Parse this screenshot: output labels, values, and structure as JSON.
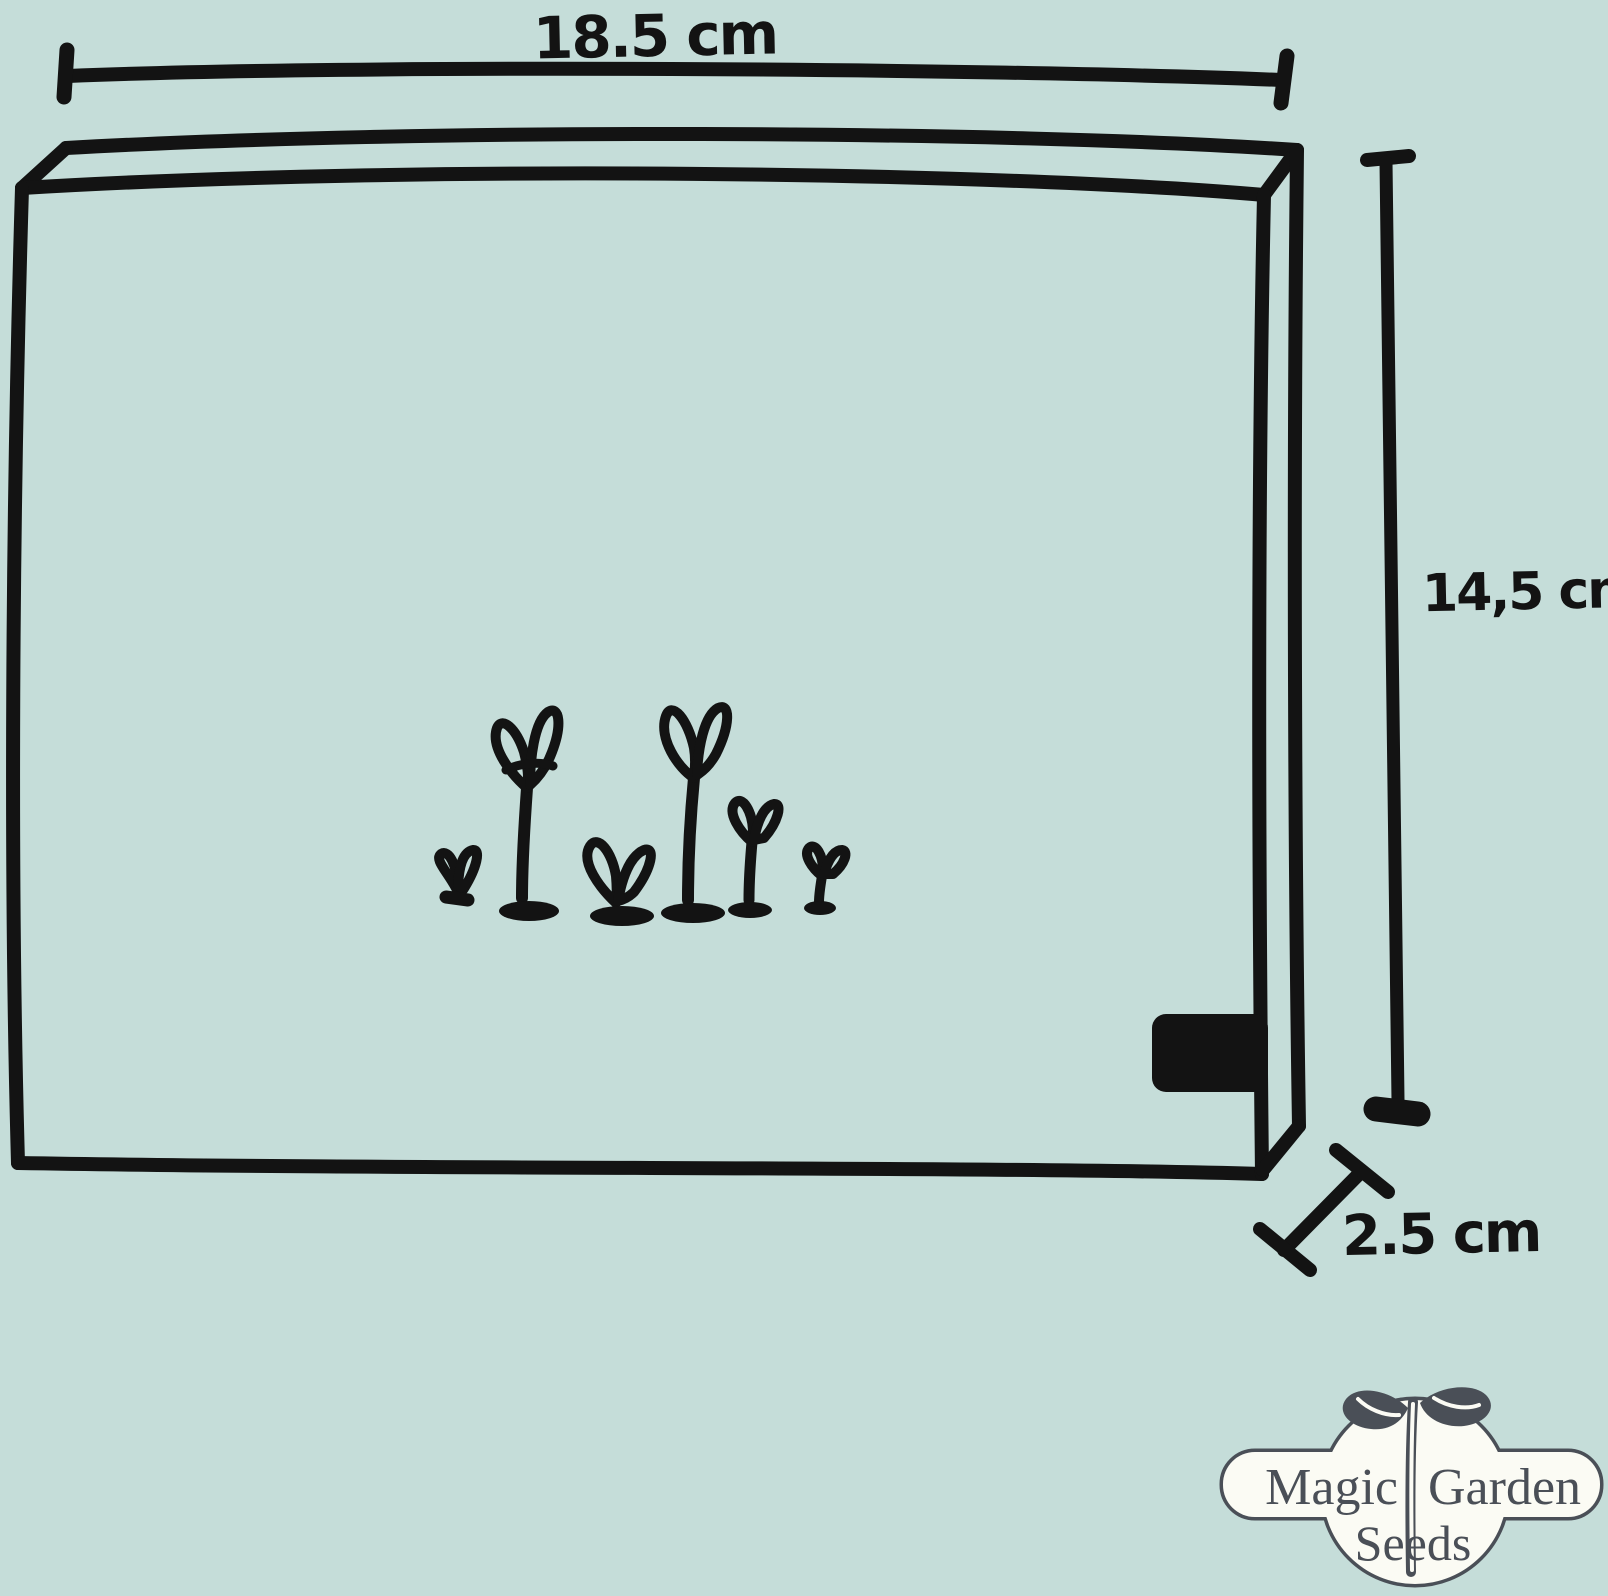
{
  "dimensions": {
    "width_label": "18.5 cm",
    "height_label": "14,5 cm",
    "depth_label": "2.5 cm"
  },
  "logo": {
    "word_magic": "Magic",
    "word_garden": "Garden",
    "word_seeds": "Seeds"
  },
  "colors": {
    "background": "#c5ddd9",
    "ink": "#131313",
    "logo_ink": "#4a4f57",
    "logo_fill": "#fbfbf4"
  }
}
